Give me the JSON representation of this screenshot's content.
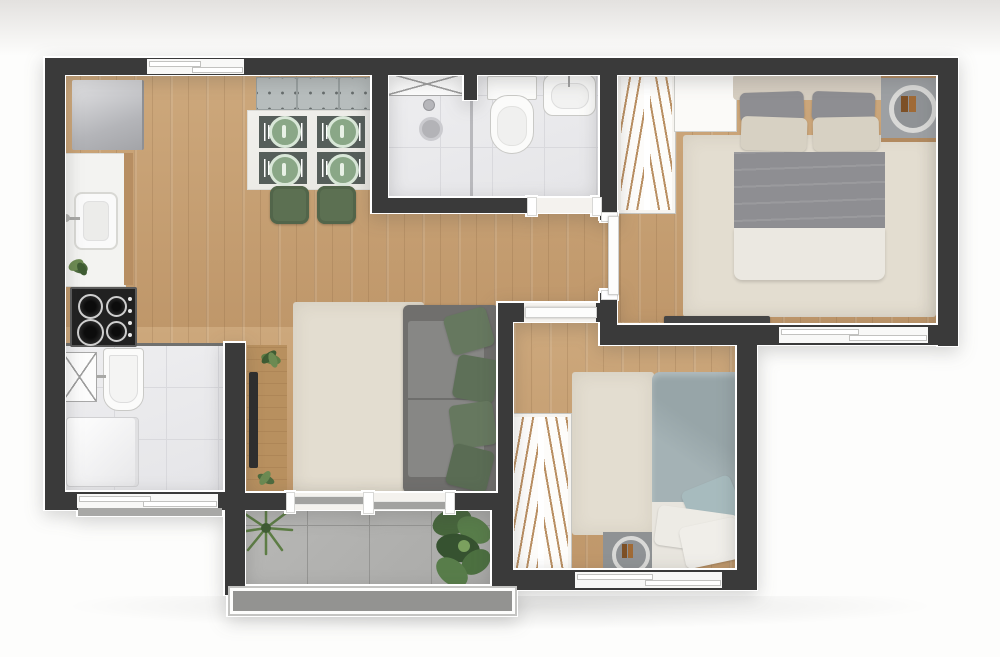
{
  "meta": {
    "type": "floor-plan",
    "view": "top-down 3d render",
    "text_labels": "none"
  },
  "palette": {
    "wall": "#3a3a3a",
    "wood": "#c7a173",
    "tileWhite": "#ebebee",
    "tileGray": "#b2b2b0",
    "rug": "#e3ddd0",
    "sofa": "#7b7b79",
    "pillowGreen": "#66785f",
    "chairGreen": "#5c7052",
    "plateGreen": "#8aa787",
    "bedGray": "#8e8e92",
    "bedBeige": "#d7d1c3",
    "duvetTeal": "#9daaad",
    "console": "#b8905f",
    "rack": "#454545",
    "parapet": "#9e9e9c",
    "hatch": "#b98f63"
  },
  "rooms": [
    {
      "id": "kitchen-dining",
      "floor": "wood",
      "furniture": [
        "refrigerator",
        "counter-with-sink",
        "gas-stove-4-burners",
        "bench-3-cushions",
        "dining-table",
        "place-settings-4",
        "green-chairs-2",
        "potted-plant"
      ]
    },
    {
      "id": "bathroom",
      "floor": "white-tile",
      "furniture": [
        "shower-area-with-drain",
        "glass-partition",
        "crossed-shower-box",
        "toilet",
        "washbasin"
      ]
    },
    {
      "id": "hall",
      "floor": "wood",
      "furniture": []
    },
    {
      "id": "bedroom-1",
      "floor": "wood",
      "furniture": [
        "hatched-wardrobe",
        "white-cabinet",
        "double-bed",
        "area-rug",
        "round-tray-nightstand",
        "tv-rack"
      ]
    },
    {
      "id": "bedroom-2",
      "floor": "wood",
      "furniture": [
        "hatched-wardrobe",
        "single-bed",
        "area-rug",
        "round-tray-nightstand",
        "tv-rack"
      ]
    },
    {
      "id": "living-room",
      "floor": "wood",
      "furniture": [
        "tv-console-with-plants",
        "tv",
        "area-rug",
        "sofa-with-4-green-pillows"
      ]
    },
    {
      "id": "laundry",
      "floor": "white-tile",
      "furniture": [
        "crossed-shaft-box",
        "laundry-tank",
        "washing-machine"
      ]
    },
    {
      "id": "balcony",
      "floor": "gray-tile",
      "furniture": [
        "palm-plant",
        "monstera-plant",
        "parapet-railing"
      ]
    }
  ],
  "openings": {
    "windows": [
      "kitchen-top",
      "bedroom-1-bottom",
      "bedroom-2-bottom",
      "laundry-bottom"
    ],
    "doors": [
      "bathroom-door",
      "bedroom-1-door",
      "bedroom-2-door",
      "balcony-sliding-door"
    ]
  }
}
